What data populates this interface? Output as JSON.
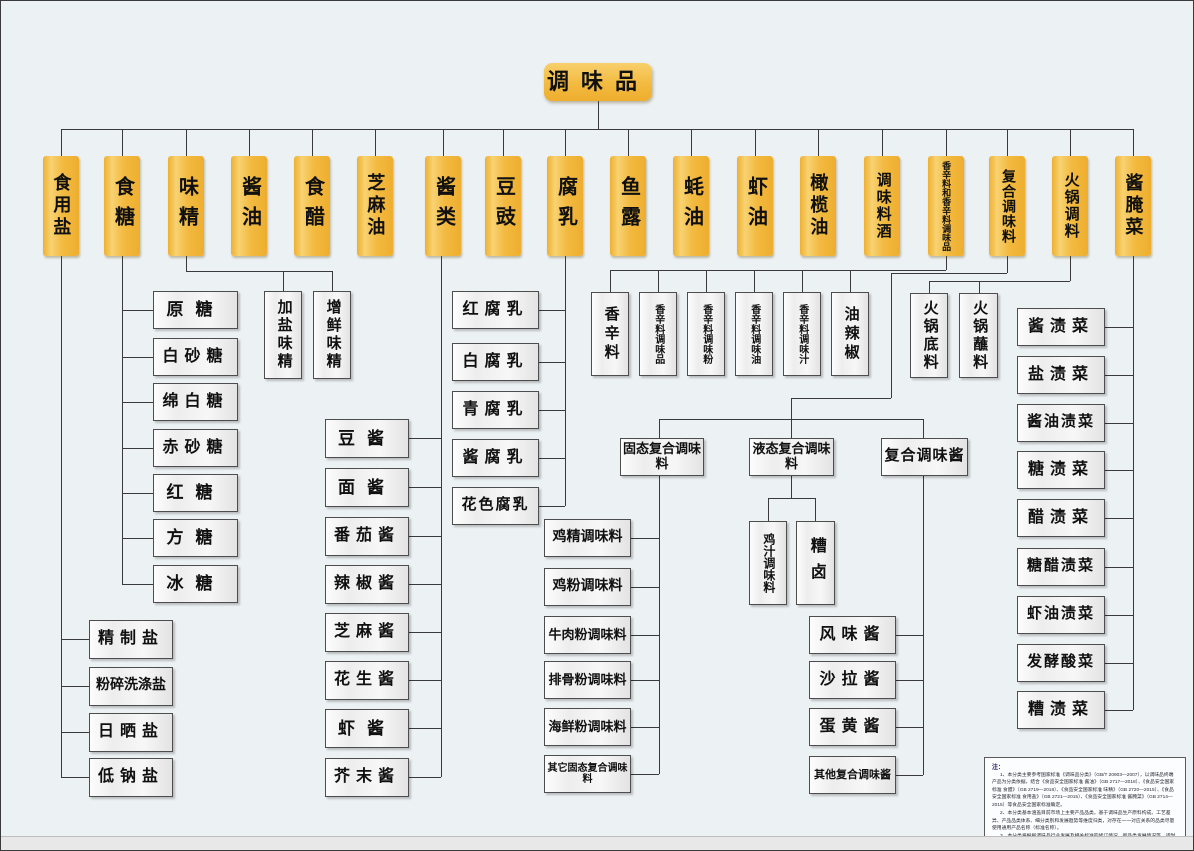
{
  "root": {
    "label": "调味品"
  },
  "level2": [
    {
      "label": "食用盐"
    },
    {
      "label": "食糖"
    },
    {
      "label": "味精"
    },
    {
      "label": "酱油"
    },
    {
      "label": "食醋"
    },
    {
      "label": "芝麻油"
    },
    {
      "label": "酱类"
    },
    {
      "label": "豆豉"
    },
    {
      "label": "腐乳"
    },
    {
      "label": "鱼露"
    },
    {
      "label": "蚝油"
    },
    {
      "label": "虾油"
    },
    {
      "label": "橄榄油"
    },
    {
      "label": "调味料酒"
    },
    {
      "label": "香辛料和香辛料调味品"
    },
    {
      "label": "复合调味料"
    },
    {
      "label": "火锅调料"
    },
    {
      "label": "酱腌菜"
    }
  ],
  "salt_children": [
    "精制盐",
    "粉碎洗涤盐",
    "日晒盐",
    "低钠盐"
  ],
  "sugar_children": [
    "原糖",
    "白砂糖",
    "绵白糖",
    "赤砂糖",
    "红糖",
    "方糖",
    "冰糖"
  ],
  "msg_children": [
    "加盐味精",
    "增鲜味精"
  ],
  "sauce_children": [
    "豆酱",
    "面酱",
    "番茄酱",
    "辣椒酱",
    "芝麻酱",
    "花生酱",
    "虾酱",
    "芥末酱"
  ],
  "tofu_children": [
    "红腐乳",
    "白腐乳",
    "青腐乳",
    "酱腐乳",
    "花色腐乳"
  ],
  "spice_children": [
    "香辛料",
    "香辛料调味品",
    "香辛料调味粉",
    "香辛料调味油",
    "香辛料调味汁",
    "油辣椒"
  ],
  "compound_children": [
    "固态复合调味料",
    "液态复合调味料",
    "复合调味酱"
  ],
  "solid_children": [
    "鸡精调味料",
    "鸡粉调味料",
    "牛肉粉调味料",
    "排骨粉调味料",
    "海鲜粉调味料",
    "其它固态复合调味料"
  ],
  "liquid_children": [
    "鸡汁调味料",
    "糟卤"
  ],
  "paste_children": [
    "风味酱",
    "沙拉酱",
    "蛋黄酱",
    "其他复合调味酱"
  ],
  "hotpot_children": [
    "火锅底料",
    "火锅蘸料"
  ],
  "pickle_children": [
    "酱渍菜",
    "盐渍菜",
    "酱油渍菜",
    "糖渍菜",
    "醋渍菜",
    "糖醋渍菜",
    "虾油渍菜",
    "发酵酸菜",
    "糟渍菜"
  ],
  "note": {
    "title": "注：",
    "items": [
      "1、本分类主要参考国家标准《调味品分类》（GB/T 20903—2007），以调味品终端产品为分类依据，结合《食品安全国家标准 酱油》（GB 2717—2018）、《食品安全国家标准 食醋》（GB 2719—2018）、《食品安全国家标准 味精》（GB 2720—2015）、《食品安全国家标准 食用盐》（GB 2721—2015）、《食品安全国家标准 酱腌菜》（GB 2714—2015）等食品安全国家标准确定。",
      "2、本分类基本涵盖目前市场上主要产品品类，基于调味品生产原料构成、工艺差异、产品品类体系、细分类别和发展趋势等维度归类，对存在一一对应关系的品类尽量使用通用产品名称（标准名称）。",
      "3、本分类将根据调味品行业发展及相关标准的修订情况、新品类发展情况等，适时对分类框架及各类别名称加以修订和完善。"
    ]
  },
  "colors": {
    "accent_orange": "#f2ba40",
    "box_border": "#4d4d4d",
    "connector": "#3a3a3a",
    "background": "#ecf1f4"
  }
}
